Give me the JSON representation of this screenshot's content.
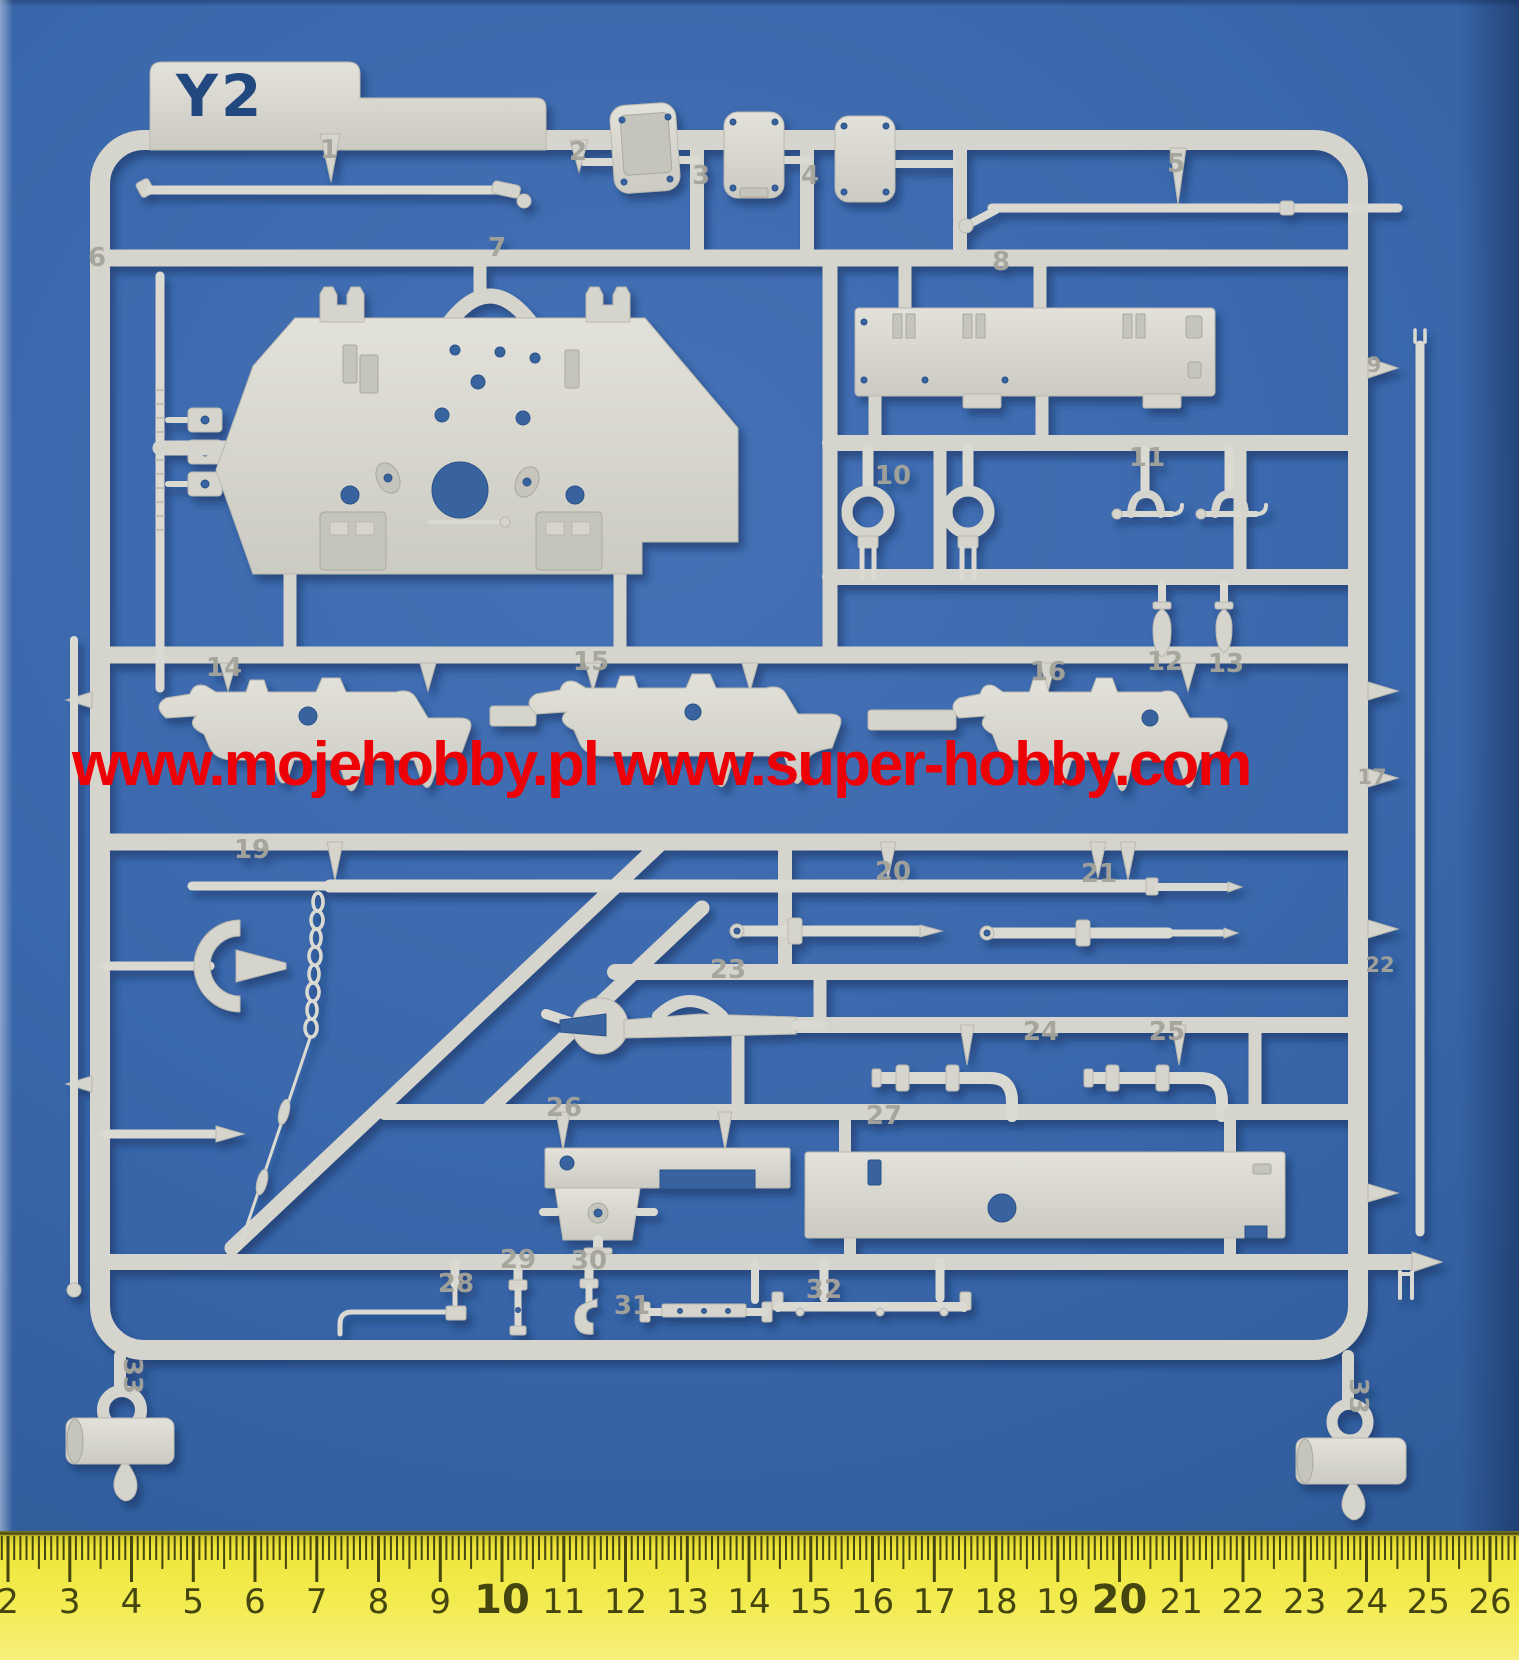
{
  "photo_subject": "plastic model kit sprue on blue mat with ruler",
  "sprue": {
    "label": "Y2",
    "part_numbers": [
      {
        "n": "1",
        "x": 329,
        "y": 158
      },
      {
        "n": "2",
        "x": 578,
        "y": 160
      },
      {
        "n": "3",
        "x": 701,
        "y": 184
      },
      {
        "n": "4",
        "x": 810,
        "y": 184
      },
      {
        "n": "5",
        "x": 1176,
        "y": 172
      },
      {
        "n": "6",
        "x": 97,
        "y": 266
      },
      {
        "n": "7",
        "x": 497,
        "y": 256
      },
      {
        "n": "8",
        "x": 1001,
        "y": 270
      },
      {
        "n": "9",
        "x": 1374,
        "y": 372,
        "size": 21
      },
      {
        "n": "10",
        "x": 893,
        "y": 484
      },
      {
        "n": "11",
        "x": 1147,
        "y": 466
      },
      {
        "n": "12",
        "x": 1165,
        "y": 670
      },
      {
        "n": "13",
        "x": 1226,
        "y": 672
      },
      {
        "n": "14",
        "x": 224,
        "y": 676
      },
      {
        "n": "15",
        "x": 591,
        "y": 670
      },
      {
        "n": "16",
        "x": 1048,
        "y": 680
      },
      {
        "n": "17",
        "x": 1372,
        "y": 784,
        "size": 21
      },
      {
        "n": "19",
        "x": 252,
        "y": 858
      },
      {
        "n": "20",
        "x": 893,
        "y": 880
      },
      {
        "n": "21",
        "x": 1099,
        "y": 882
      },
      {
        "n": "22",
        "x": 1380,
        "y": 972,
        "size": 21
      },
      {
        "n": "23",
        "x": 728,
        "y": 978
      },
      {
        "n": "24",
        "x": 1041,
        "y": 1040
      },
      {
        "n": "25",
        "x": 1167,
        "y": 1040
      },
      {
        "n": "26",
        "x": 564,
        "y": 1116
      },
      {
        "n": "27",
        "x": 884,
        "y": 1124
      },
      {
        "n": "28",
        "x": 456,
        "y": 1292
      },
      {
        "n": "29",
        "x": 518,
        "y": 1268
      },
      {
        "n": "30",
        "x": 589,
        "y": 1269
      },
      {
        "n": "31",
        "x": 632,
        "y": 1314
      },
      {
        "n": "32",
        "x": 824,
        "y": 1298
      },
      {
        "n": "33",
        "x": 124,
        "y": 1376,
        "rot": 90
      },
      {
        "n": "33",
        "x": 1350,
        "y": 1396,
        "rot": 90
      }
    ]
  },
  "watermark": {
    "text": "www.mojehobby.pl www.super-hobby.com"
  },
  "ruler": {
    "numbers": [
      "2",
      "3",
      "4",
      "5",
      "6",
      "7",
      "8",
      "9",
      "10",
      "11",
      "12",
      "13",
      "14",
      "15",
      "16",
      "17",
      "18",
      "19",
      "20",
      "21",
      "22",
      "23",
      "24",
      "25",
      "26"
    ],
    "bold": [
      "10",
      "20"
    ],
    "unit": "cm"
  },
  "colors": {
    "mat_blue": "#3a67ab",
    "plastic": "#d6d5cd",
    "watermark_red": "#ee0007",
    "ruler_yellow": "#f2ea3f",
    "ruler_ink": "#45450f",
    "label_navy": "#24497f"
  }
}
